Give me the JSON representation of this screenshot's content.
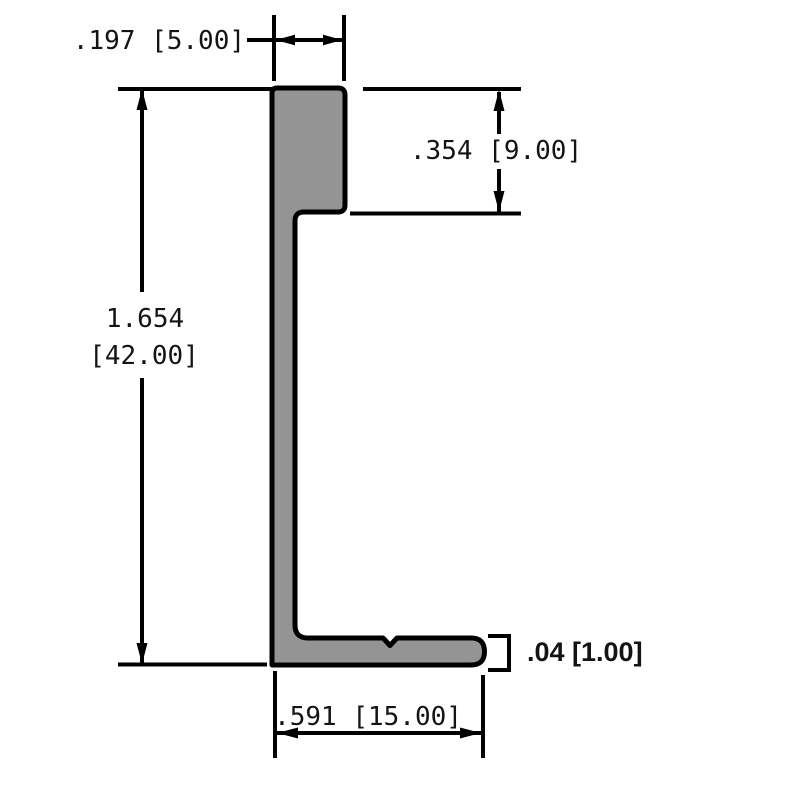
{
  "drawing": {
    "kind": "extrusion-profile-cross-section",
    "background_color": "#ffffff",
    "profile_fill_color": "#949494",
    "line_color": "#000000",
    "dimensions": {
      "top_width": {
        "label": ".197 [5.00]",
        "inches": ".197",
        "mm": "5.00"
      },
      "upper_step_height": {
        "label": ".354 [9.00]",
        "inches": ".354",
        "mm": "9.00"
      },
      "overall_height": {
        "inches": "1.654",
        "mm_bracketed": "[42.00]"
      },
      "flange_thickness": {
        "label": ".04 [1.00]",
        "inches": ".04",
        "mm": "1.00"
      },
      "bottom_width": {
        "label": ".591 [15.00]",
        "inches": ".591",
        "mm": "15.00"
      }
    }
  }
}
